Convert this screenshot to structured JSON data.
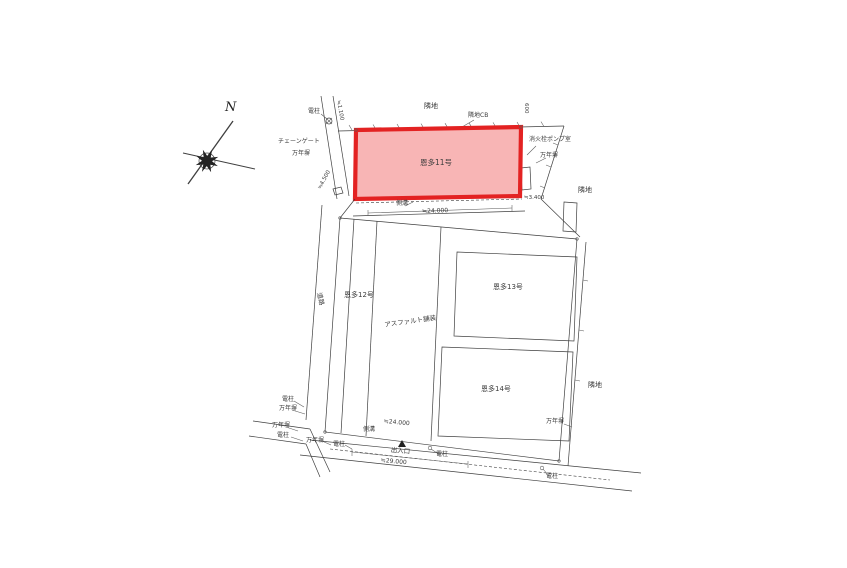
{
  "compass": {
    "north": "N"
  },
  "parcels": {
    "p11": {
      "label": "恩多11号",
      "highlighted": true
    },
    "p12": {
      "label": "恩多12号"
    },
    "p13": {
      "label": "恩多13号"
    },
    "p14": {
      "label": "恩多14号"
    }
  },
  "surface": {
    "asphalt": "アスファルト舗装"
  },
  "features": {
    "neighbor": "隣地",
    "neighbor_cb": "隣地CB",
    "utility_pole": "電柱",
    "concrete_fence": "万年塀",
    "chain_gate": "チェーンゲート",
    "pump_room": "消火栓ポンプ室",
    "road": "道路",
    "gutter": "側溝",
    "entrance": "出入口"
  },
  "dimensions": {
    "top_edge": "600",
    "left_edge": "≒1.100",
    "west_offset": "≒4.500",
    "east_offset": "≒3.400",
    "upper_width": "≒24.000",
    "lower_width": "≒24.000",
    "frontage": "≒29.000"
  },
  "colors": {
    "highlight_fill": "#f59c9c",
    "highlight_stroke": "#e32222",
    "line": "#3f3f3f"
  }
}
